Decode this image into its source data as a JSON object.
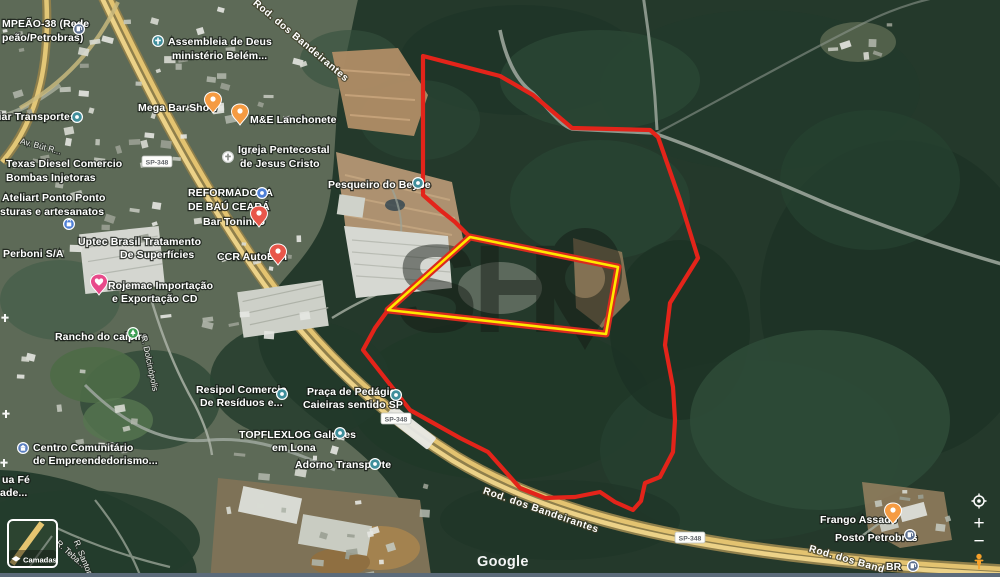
{
  "controls": {
    "attribution": "Google",
    "layers_label": "Camadas",
    "zoom_in": "+",
    "zoom_out": "−",
    "my_location_icon": "my-location-icon",
    "pegman_icon": "street-view-pegman-icon"
  },
  "overlay": {
    "watermark": {
      "text": "SH",
      "pin_glyph": "map-pin",
      "color": "#141a14"
    },
    "red_polygon": {
      "color": "#e3241a",
      "points": [
        [
          423,
          56
        ],
        [
          500,
          76
        ],
        [
          533,
          95
        ],
        [
          572,
          128
        ],
        [
          650,
          130
        ],
        [
          658,
          137
        ],
        [
          673,
          180
        ],
        [
          680,
          200
        ],
        [
          698,
          258
        ],
        [
          670,
          303
        ],
        [
          665,
          345
        ],
        [
          673,
          387
        ],
        [
          675,
          420
        ],
        [
          673,
          452
        ],
        [
          660,
          477
        ],
        [
          645,
          483
        ],
        [
          641,
          501
        ],
        [
          633,
          510
        ],
        [
          615,
          502
        ],
        [
          600,
          492
        ],
        [
          575,
          497
        ],
        [
          545,
          498
        ],
        [
          520,
          488
        ],
        [
          488,
          452
        ],
        [
          460,
          438
        ],
        [
          410,
          410
        ],
        [
          363,
          350
        ],
        [
          375,
          328
        ],
        [
          388,
          310
        ],
        [
          470,
          237
        ],
        [
          455,
          222
        ],
        [
          440,
          210
        ],
        [
          423,
          195
        ]
      ]
    },
    "yellow_parcel": {
      "color": "#ffe800",
      "outer_color": "#d92b1f",
      "points": [
        [
          388,
          310
        ],
        [
          470,
          237
        ],
        [
          618,
          267
        ],
        [
          606,
          334
        ]
      ]
    }
  },
  "roads": {
    "shield_label": "SP-348",
    "shields": [
      {
        "x": 157,
        "y": 162
      },
      {
        "x": 396,
        "y": 419
      },
      {
        "x": 690,
        "y": 538
      }
    ]
  },
  "labels": [
    {
      "t": "MPEÃO-38 (Rede",
      "x": 2,
      "y": 27
    },
    {
      "t": "peão/Petrobras)",
      "x": 2,
      "y": 41
    },
    {
      "t": "uiar Transportes",
      "x": -8,
      "y": 120
    },
    {
      "t": "Assembleia de Deus",
      "x": 168,
      "y": 45
    },
    {
      "t": "ministério Belém...",
      "x": 172,
      "y": 59
    },
    {
      "t": "Mega Bar Show",
      "x": 138,
      "y": 111
    },
    {
      "t": "M&E Lanchonete",
      "x": 250,
      "y": 123
    },
    {
      "t": "Igreja Pentecostal",
      "x": 238,
      "y": 153
    },
    {
      "t": "de Jesus Cristo",
      "x": 240,
      "y": 167
    },
    {
      "t": "Pesqueiro do Beybe",
      "x": 328,
      "y": 188
    },
    {
      "t": "REFORMADORA",
      "x": 188,
      "y": 196
    },
    {
      "t": "DE BAÚ CEARÁ",
      "x": 188,
      "y": 210
    },
    {
      "t": "Bar Toninho",
      "x": 203,
      "y": 225
    },
    {
      "t": "CCR AutoBan",
      "x": 217,
      "y": 260
    },
    {
      "t": "Texas Diesel Comercio",
      "x": 6,
      "y": 167
    },
    {
      "t": "Bombas Injetoras",
      "x": 6,
      "y": 181
    },
    {
      "t": "Ateliart Ponto Ponto",
      "x": 2,
      "y": 201
    },
    {
      "t": "sturas e artesanatos",
      "x": 0,
      "y": 215
    },
    {
      "t": "Uptec Brasil Tratamento",
      "x": 78,
      "y": 245
    },
    {
      "t": "De Superfícies",
      "x": 120,
      "y": 258
    },
    {
      "t": "Perboni S/A",
      "x": 3,
      "y": 257
    },
    {
      "t": "Rojemac Importação",
      "x": 108,
      "y": 289
    },
    {
      "t": "e Exportação CD",
      "x": 112,
      "y": 302
    },
    {
      "t": "Rancho do caipira",
      "x": 55,
      "y": 340
    },
    {
      "t": "Resipol Comercio",
      "x": 196,
      "y": 393
    },
    {
      "t": "De Resíduos e...",
      "x": 200,
      "y": 406
    },
    {
      "t": "Praça de Pedágio",
      "x": 307,
      "y": 395
    },
    {
      "t": "Caieiras sentido SP",
      "x": 303,
      "y": 408
    },
    {
      "t": "TOPFLEXLOG Galpões",
      "x": 239,
      "y": 438
    },
    {
      "t": "em Lona",
      "x": 272,
      "y": 451
    },
    {
      "t": "Adorno Transporte",
      "x": 295,
      "y": 468
    },
    {
      "t": "Centro Comunitário",
      "x": 33,
      "y": 451
    },
    {
      "t": "de Empreendedorismo...",
      "x": 33,
      "y": 464
    },
    {
      "t": "ua Fé",
      "x": 2,
      "y": 483
    },
    {
      "t": "ade...",
      "x": 0,
      "y": 496
    },
    {
      "t": "Frango Assado",
      "x": 820,
      "y": 523
    },
    {
      "t": "Posto Petrobras",
      "x": 835,
      "y": 541
    },
    {
      "t": "BR",
      "x": 886,
      "y": 570
    },
    {
      "t": "Rod. dos Bandeirantes",
      "x": 299,
      "y": 43,
      "c": "road",
      "r": 40,
      "a": "middle"
    },
    {
      "t": "Rod. dos Bandeirantes",
      "x": 540,
      "y": 513,
      "c": "road",
      "r": 19,
      "a": "middle"
    },
    {
      "t": "Rod. dos Band",
      "x": 846,
      "y": 562,
      "c": "road",
      "r": 16,
      "a": "middle"
    },
    {
      "t": "R. Dolcinópolis",
      "x": 147,
      "y": 364,
      "c": "street",
      "r": 78,
      "a": "middle"
    },
    {
      "t": "R. Teba...",
      "x": 69,
      "y": 556,
      "c": "street",
      "r": 42,
      "a": "middle"
    },
    {
      "t": "R. Santorini",
      "x": 82,
      "y": 562,
      "c": "street",
      "r": 68,
      "a": "middle"
    },
    {
      "t": "Av. Bút R...",
      "x": 40,
      "y": 149,
      "c": "street",
      "r": 15,
      "a": "middle"
    }
  ],
  "markers": [
    {
      "k": "gas",
      "x": 79,
      "y": 29
    },
    {
      "k": "church-teal",
      "x": 158,
      "y": 41
    },
    {
      "k": "dot-teal",
      "x": 77,
      "y": 117
    },
    {
      "k": "pin-orange",
      "x": 213,
      "y": 103
    },
    {
      "k": "pin-orange",
      "x": 240,
      "y": 115
    },
    {
      "k": "church-white",
      "x": 228,
      "y": 157
    },
    {
      "k": "dot-teal",
      "x": 418,
      "y": 183
    },
    {
      "k": "dot-blue",
      "x": 262,
      "y": 193
    },
    {
      "k": "pin-red",
      "x": 259,
      "y": 217
    },
    {
      "k": "pin-red",
      "x": 278,
      "y": 255
    },
    {
      "k": "shop-blue",
      "x": 69,
      "y": 224
    },
    {
      "k": "heart-pink",
      "x": 99,
      "y": 285
    },
    {
      "k": "tree-green",
      "x": 133,
      "y": 333
    },
    {
      "k": "dot-teal",
      "x": 282,
      "y": 394
    },
    {
      "k": "dot-teal",
      "x": 396,
      "y": 395
    },
    {
      "k": "dot-teal",
      "x": 340,
      "y": 433
    },
    {
      "k": "dot-teal",
      "x": 375,
      "y": 464
    },
    {
      "k": "bank-blue",
      "x": 23,
      "y": 448
    },
    {
      "k": "cross-white",
      "x": 5,
      "y": 318
    },
    {
      "k": "cross-white",
      "x": 6,
      "y": 414
    },
    {
      "k": "cross-white",
      "x": 4,
      "y": 463
    },
    {
      "k": "pin-orange",
      "x": 893,
      "y": 514
    },
    {
      "k": "gas",
      "x": 910,
      "y": 535
    },
    {
      "k": "gas",
      "x": 913,
      "y": 566
    }
  ]
}
